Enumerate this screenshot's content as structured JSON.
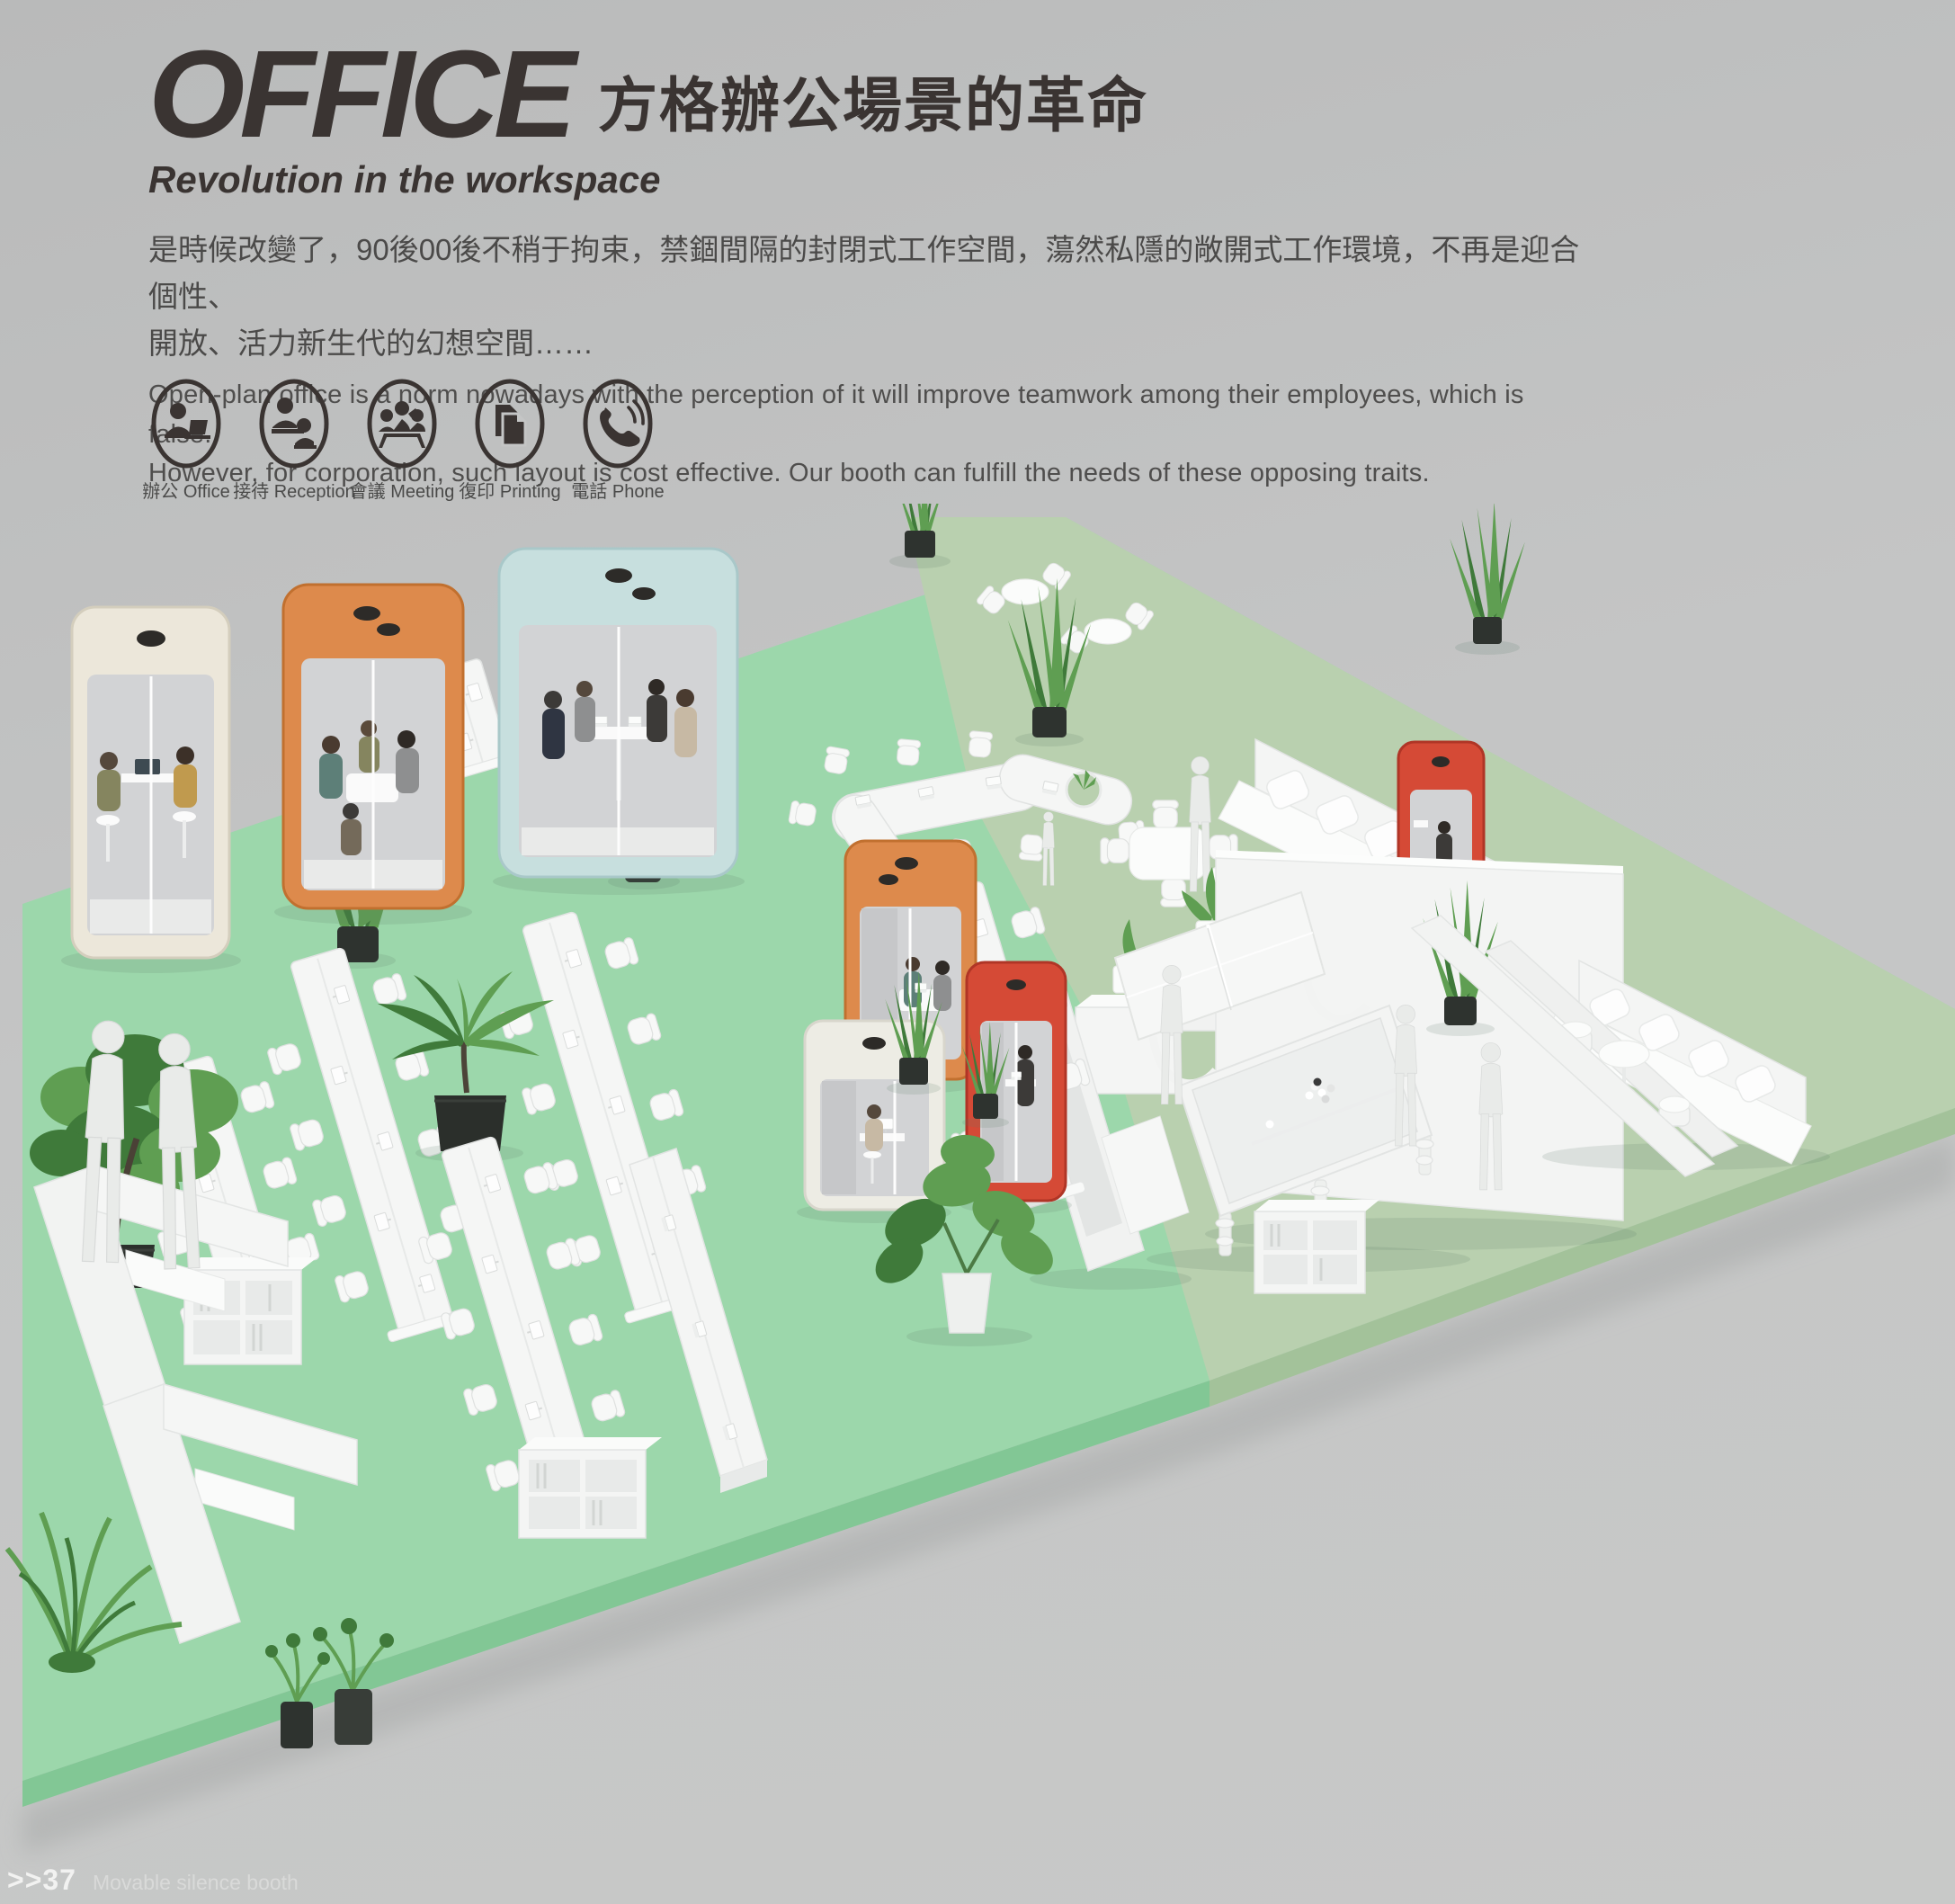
{
  "page": {
    "footer_marker": ">>37",
    "footer_caption": "Movable silence booth"
  },
  "header": {
    "title_en": "OFFICE",
    "title_zh": "方格辦公場景的革命",
    "subtitle": "Revolution in the workspace",
    "intro_zh": [
      "是時候改變了，90後00後不稍于拘束，禁錮間隔的封閉式工作空間，蕩然私隱的敞開式工作環境，不再是迎合個性、",
      "開放、活力新生代的幻想空間……"
    ],
    "intro_en": [
      "Open-plan office is a norm nowadays with the perception of it will improve teamwork among their employees, which is false.",
      "However, for corporation, such layout is cost effective. Our booth can fulfill the needs of these opposing traits."
    ]
  },
  "features": [
    {
      "id": "office",
      "icon": "office-icon",
      "label": "辦公 Office"
    },
    {
      "id": "reception",
      "icon": "reception-icon",
      "label": "接待 Reception"
    },
    {
      "id": "meeting",
      "icon": "meeting-icon",
      "label": "會議 Meeting"
    },
    {
      "id": "printing",
      "icon": "printing-icon",
      "label": "復印 Printing"
    },
    {
      "id": "phone",
      "icon": "phone-icon",
      "label": "電話 Phone"
    }
  ],
  "theme": {
    "bg": "#c4c5c5",
    "bg-top": "#b9baba",
    "ink": "#3a3432",
    "text": "#4b4a49",
    "text2": "#4f4e4d",
    "mint": "#9cd7ab",
    "mint-edge": "#82c795",
    "sage": "#b9d0af",
    "sage-edge": "#a3c29a",
    "glass": "#d2d3d5",
    "leaf": "#5f9e52",
    "leaf-dark": "#3f7a3a",
    "pot-dark": "#2e332f",
    "figure": "#e9ebe9",
    "footer-text": "#f2f2f1",
    "booth-orange": "#dd8a4c",
    "booth-orange-dark": "#c1702f",
    "booth-blue": "#c7dfde",
    "booth-blue-dark": "#a9c8c9",
    "booth-cream": "#ece7da",
    "booth-cream-dark": "#d4cebd",
    "booth-red": "#d54a36",
    "booth-red-dark": "#b03526",
    "booth-white": "#edece4"
  }
}
